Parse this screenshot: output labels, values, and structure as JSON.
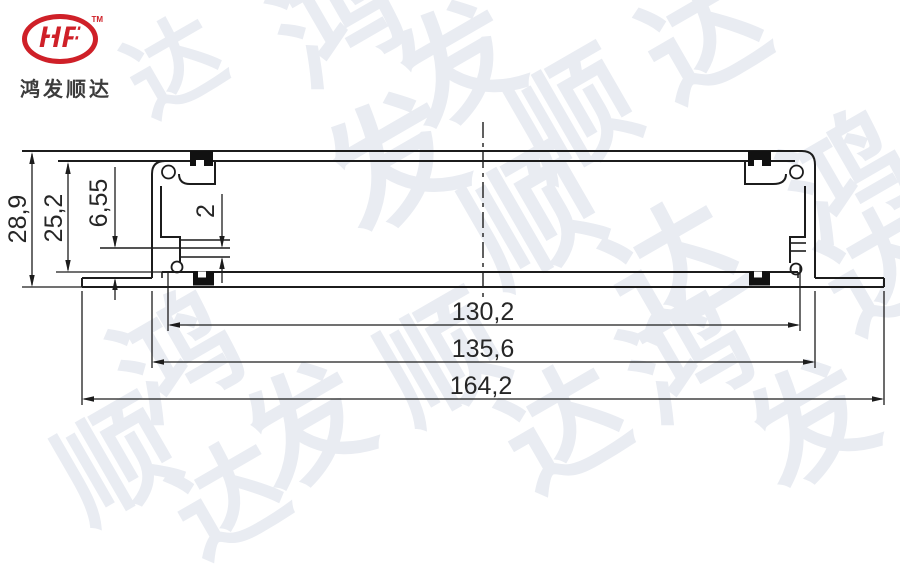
{
  "brand": {
    "logo_text": "HF",
    "trademark": "TM",
    "company_name": "鸿发顺达",
    "logo_red": "#cf2028",
    "name_color": "#3c3c3c"
  },
  "watermark": {
    "text": "鸿发顺达",
    "color": "#e9ecf2",
    "items": [
      {
        "ch": "鸿",
        "x": 278,
        "y": -38,
        "s": 120
      },
      {
        "ch": "发",
        "x": 398,
        "y": 6,
        "s": 120
      },
      {
        "ch": "顺",
        "x": 515,
        "y": 56,
        "s": 120
      },
      {
        "ch": "达",
        "x": 645,
        "y": -22,
        "s": 120
      },
      {
        "ch": "达",
        "x": 128,
        "y": 20,
        "s": 95
      },
      {
        "ch": "发",
        "x": 330,
        "y": 98,
        "s": 130
      },
      {
        "ch": "顺",
        "x": 468,
        "y": 152,
        "s": 130
      },
      {
        "ch": "达",
        "x": 610,
        "y": 205,
        "s": 130
      },
      {
        "ch": "鸿",
        "x": 788,
        "y": 118,
        "s": 120
      },
      {
        "ch": "达",
        "x": 825,
        "y": 210,
        "s": 120
      },
      {
        "ch": "鸿",
        "x": 118,
        "y": 298,
        "s": 120
      },
      {
        "ch": "发",
        "x": 248,
        "y": 368,
        "s": 120
      },
      {
        "ch": "顺",
        "x": 383,
        "y": 300,
        "s": 120
      },
      {
        "ch": "达",
        "x": 505,
        "y": 368,
        "s": 120
      },
      {
        "ch": "鸿",
        "x": 628,
        "y": 298,
        "s": 120
      },
      {
        "ch": "发",
        "x": 752,
        "y": 365,
        "s": 120
      },
      {
        "ch": "顺",
        "x": 60,
        "y": 405,
        "s": 115
      },
      {
        "ch": "达",
        "x": 175,
        "y": 445,
        "s": 110
      }
    ]
  },
  "drawing": {
    "line_color": "#1c1c1c",
    "dim_color": "#262626",
    "dimensions": {
      "total_height": {
        "label": "28,9"
      },
      "inner_height": {
        "label": "25,2"
      },
      "step_height": {
        "label": "6,55"
      },
      "slot_width": {
        "label": "2"
      },
      "inner_width": {
        "label": "130,2"
      },
      "body_width": {
        "label": "135,6"
      },
      "total_width": {
        "label": "164,2"
      }
    }
  }
}
